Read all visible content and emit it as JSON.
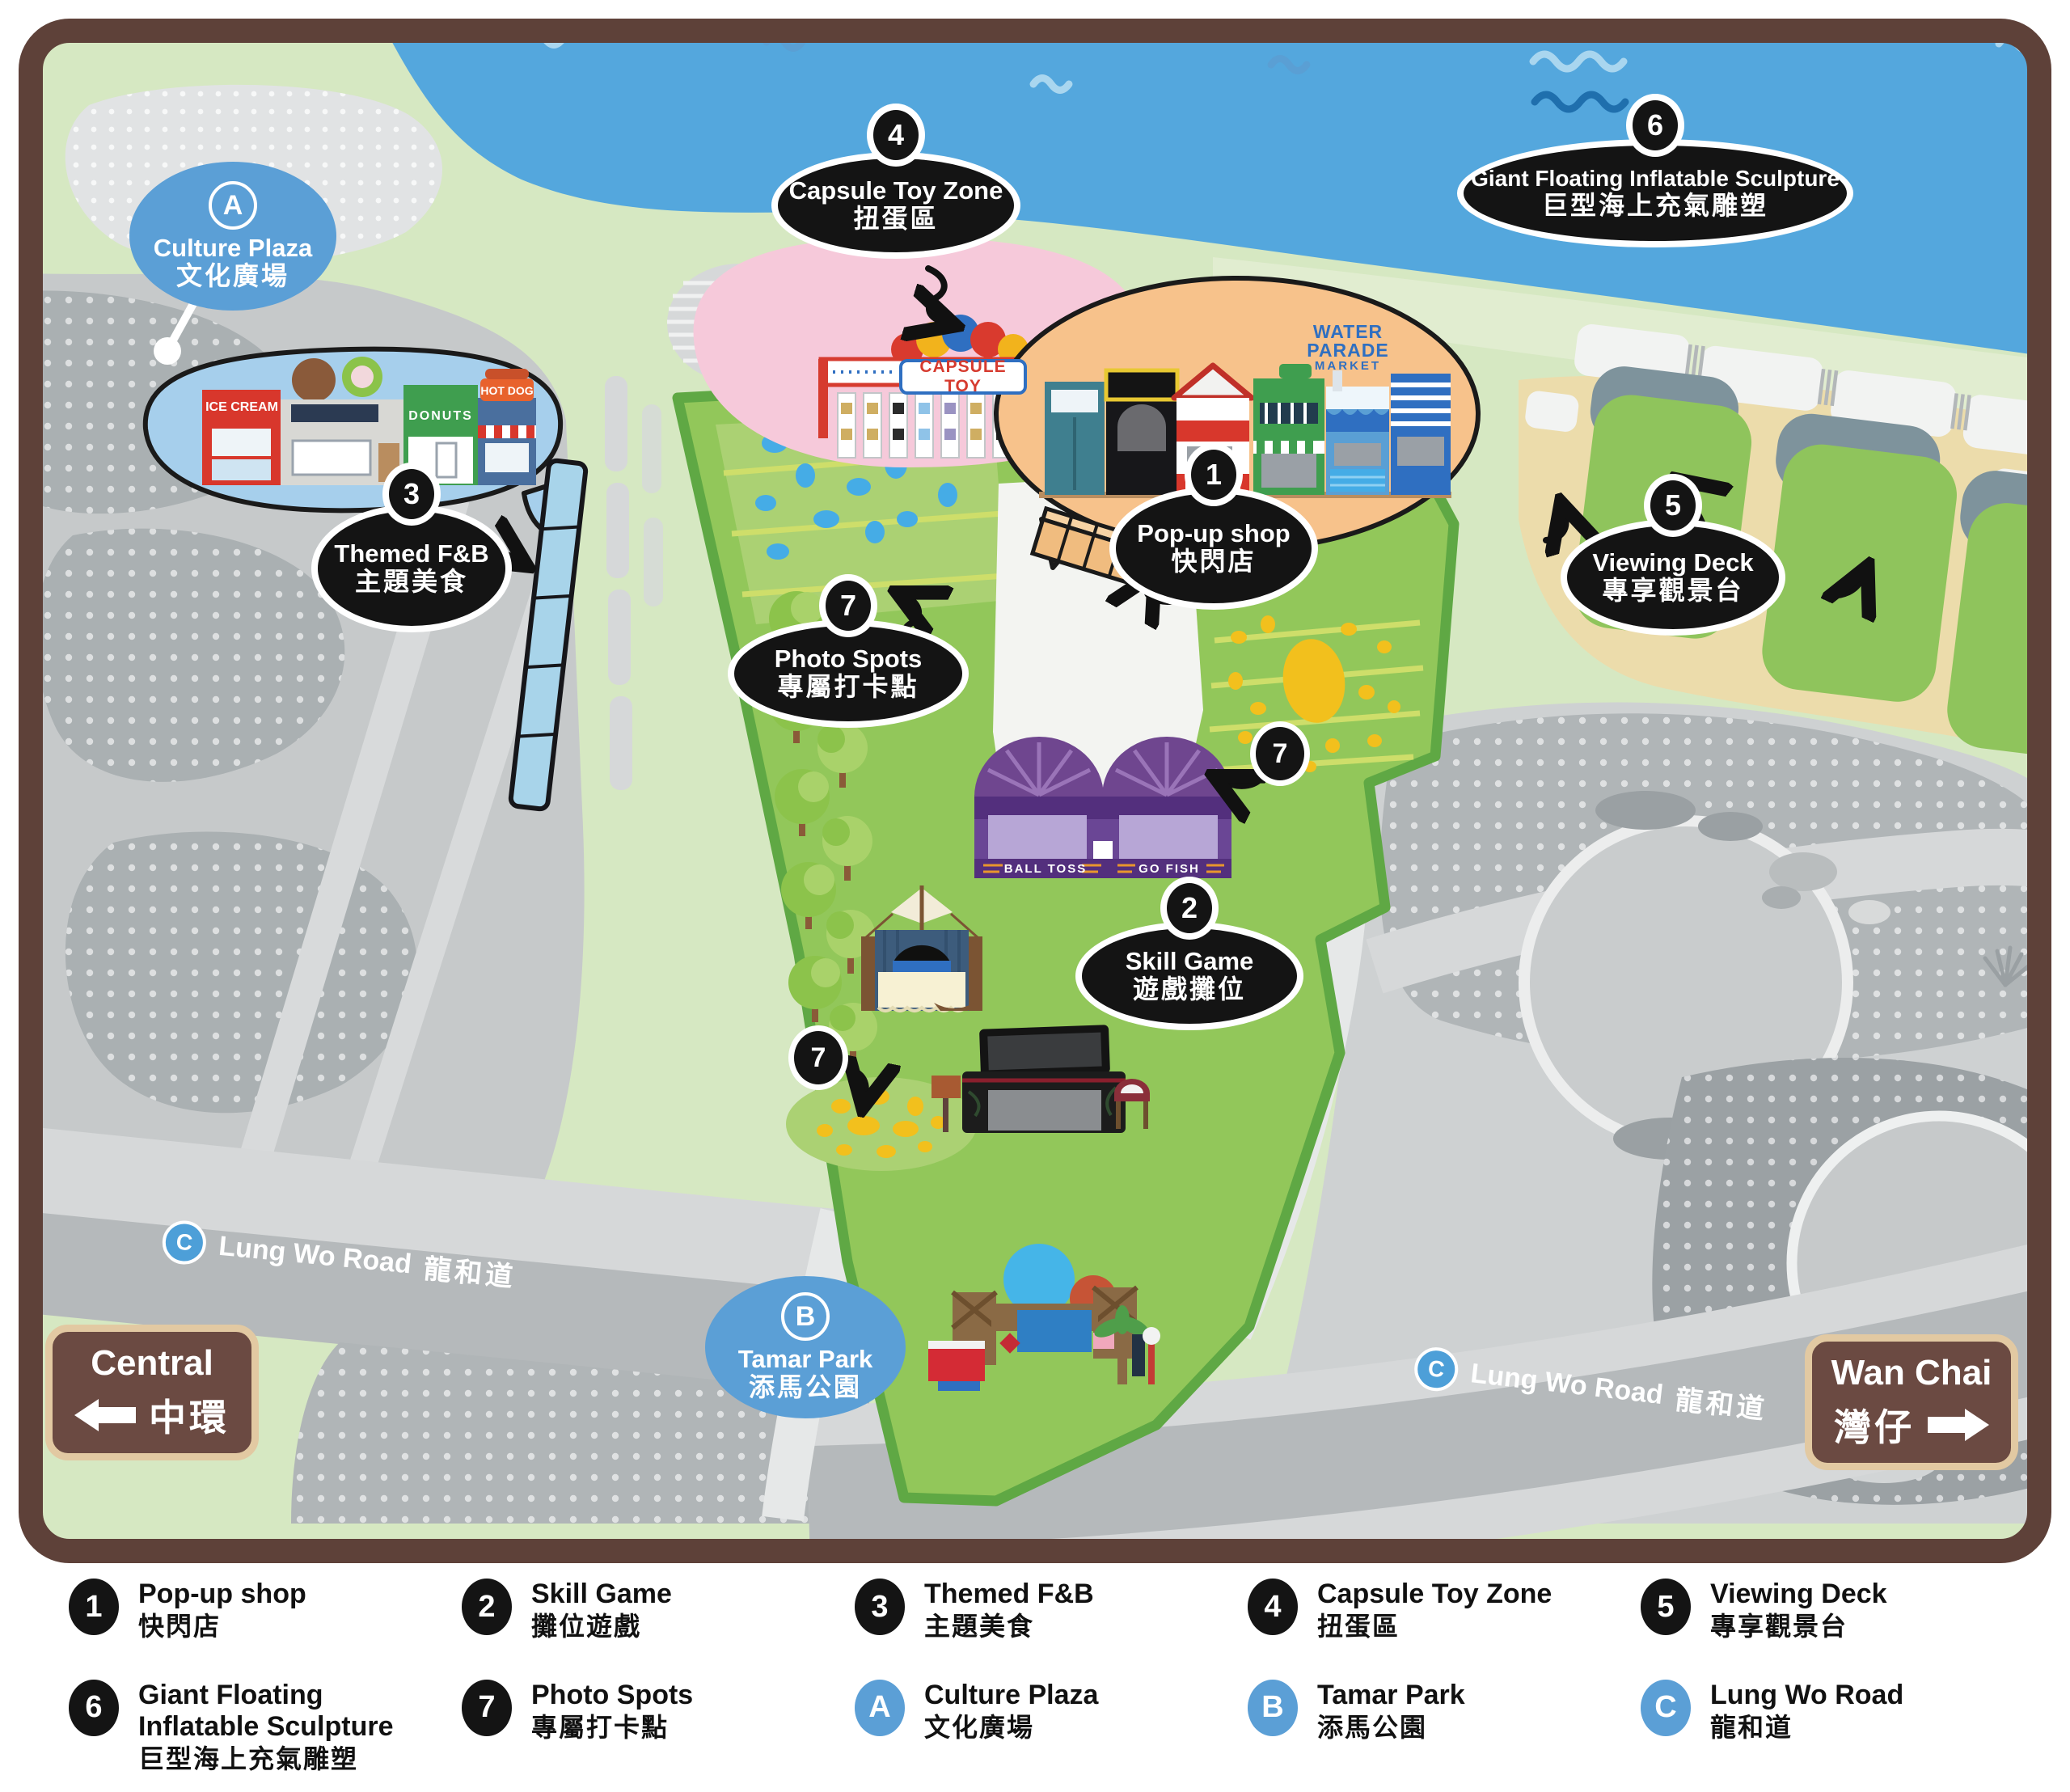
{
  "colors": {
    "water": "#54a7dd",
    "shore_green": "#d6e8c2",
    "park_green": "#92c75a",
    "park_edge": "#5fa844",
    "sand": "#ecdcab",
    "pink_zone": "#f6c9da",
    "orange_bubble": "#f7c28b",
    "fnb_bubble": "#a6cfec",
    "label_black": "#141414",
    "label_blue": "#5b9fd6",
    "sign_brown": "#6b4a42",
    "sign_border": "#e2c9a2",
    "map_border": "#5e4139",
    "booth_purple": "#6a4695",
    "duck_yellow": "#f2c01d",
    "road_gray": "#b5b9bb"
  },
  "map": {
    "labels": {
      "culture_plaza": {
        "marker": "A",
        "en": "Culture Plaza",
        "zh": "文化廣場"
      },
      "capsule_toy_zone": {
        "marker": "4",
        "en": "Capsule Toy Zone",
        "zh": "扭蛋區"
      },
      "inflatable_sculpture": {
        "marker": "6",
        "en": "Giant Floating Inflatable Sculpture",
        "zh": "巨型海上充氣雕塑"
      },
      "themed_fnb": {
        "marker": "3",
        "en": "Themed F&B",
        "zh": "主題美食"
      },
      "popup_shop": {
        "marker": "1",
        "en": "Pop-up shop",
        "zh": "快閃店"
      },
      "viewing_deck": {
        "marker": "5",
        "en": "Viewing Deck",
        "zh": "專享觀景台"
      },
      "photo_spots": {
        "marker": "7",
        "en": "Photo Spots",
        "zh": "專屬打卡點"
      },
      "skill_game": {
        "marker": "2",
        "en": "Skill Game",
        "zh": "遊戲攤位"
      },
      "tamar_park": {
        "marker": "B",
        "en": "Tamar Park",
        "zh": "添馬公園"
      },
      "photo_spot_marker_right": "7",
      "photo_spot_marker_pond": "7"
    },
    "roads": {
      "lung_wo_left": {
        "marker": "C",
        "en": "Lung Wo Road",
        "zh": "龍和道"
      },
      "lung_wo_right": {
        "marker": "C",
        "en": "Lung Wo Road",
        "zh": "龍和道"
      }
    },
    "signs": {
      "central": {
        "en": "Central",
        "zh": "中環"
      },
      "wan_chai": {
        "en": "Wan Chai",
        "zh": "灣仔"
      }
    },
    "illustrations": {
      "capsule_machine_sign": "CAPSULE TOY",
      "market_sign_top": "WATER PARADE",
      "market_sign_bottom": "MARKET",
      "shop_ice_cream": "ICE CREAM",
      "shop_donuts": "DONUTS",
      "shop_hot_dog": "HOT DOG",
      "game_ball_toss": "BALL TOSS",
      "game_go_fish": "GO FISH"
    }
  },
  "legend": {
    "items": [
      {
        "marker": "1",
        "en": "Pop-up shop",
        "zh": "快閃店"
      },
      {
        "marker": "2",
        "en": "Skill Game",
        "zh": "攤位遊戲"
      },
      {
        "marker": "3",
        "en": "Themed F&B",
        "zh": "主題美食"
      },
      {
        "marker": "4",
        "en": "Capsule Toy Zone",
        "zh": "扭蛋區"
      },
      {
        "marker": "5",
        "en": "Viewing Deck",
        "zh": "專享觀景台"
      },
      {
        "marker": "6",
        "en": "Giant Floating Inflatable Sculpture",
        "zh": "巨型海上充氣雕塑"
      },
      {
        "marker": "7",
        "en": "Photo Spots",
        "zh": "專屬打卡點"
      },
      {
        "marker": "A",
        "en": "Culture Plaza",
        "zh": "文化廣場"
      },
      {
        "marker": "B",
        "en": "Tamar Park",
        "zh": "添馬公園"
      },
      {
        "marker": "C",
        "en": "Lung Wo Road",
        "zh": "龍和道"
      }
    ]
  }
}
